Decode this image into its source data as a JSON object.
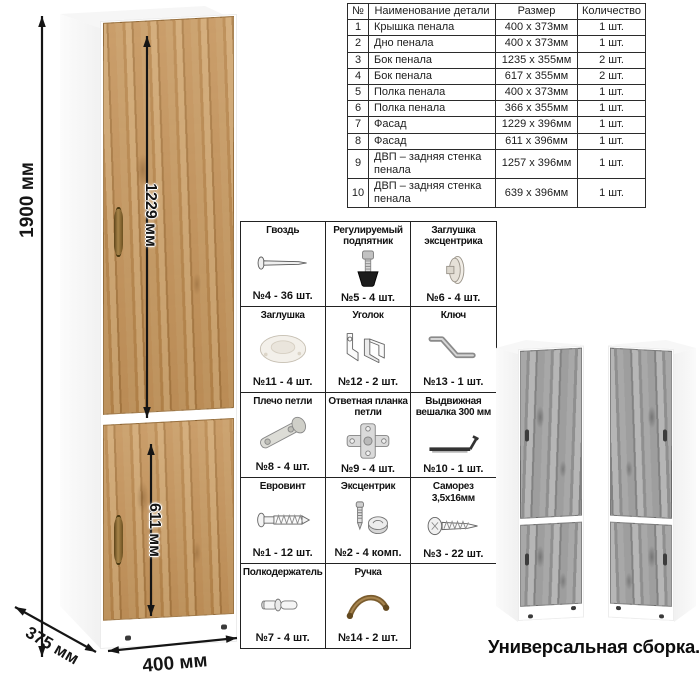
{
  "dims": {
    "height": "1900 мм",
    "upper_door": "1229 мм",
    "lower_door": "611 мм",
    "width": "400 мм",
    "depth": "375 мм"
  },
  "caption": "Универсальная сборка.",
  "parts_table": {
    "headers": [
      "№",
      "Наименование детали",
      "Размер",
      "Количество"
    ],
    "rows": [
      [
        "1",
        "Крышка пенала",
        "400 x 373мм",
        "1 шт."
      ],
      [
        "2",
        "Дно пенала",
        "400 x 373мм",
        "1 шт."
      ],
      [
        "3",
        "Бок пенала",
        "1235 x 355мм",
        "2 шт."
      ],
      [
        "4",
        "Бок пенала",
        "617 x 355мм",
        "2 шт."
      ],
      [
        "5",
        "Полка пенала",
        "400 x 373мм",
        "1 шт."
      ],
      [
        "6",
        "Полка пенала",
        "366 x 355мм",
        "1 шт."
      ],
      [
        "7",
        "Фасад",
        "1229 x 396мм",
        "1 шт."
      ],
      [
        "8",
        "Фасад",
        "611 x 396мм",
        "1 шт."
      ],
      [
        "9",
        "ДВП – задняя стенка пенала",
        "1257 x 396мм",
        "1 шт."
      ],
      [
        "10",
        "ДВП – задняя стенка пенала",
        "639 x 396мм",
        "1 шт."
      ]
    ]
  },
  "hardware": {
    "items": [
      {
        "name": "Гвоздь",
        "qty": "№4 - 36 шт.",
        "icon": "nail-icon"
      },
      {
        "name": "Регулируемый подпятник",
        "qty": "№5 - 4 шт.",
        "icon": "adjustable-foot-icon"
      },
      {
        "name": "Заглушка эксцентрика",
        "qty": "№6 - 4 шт.",
        "icon": "cam-cap-icon"
      },
      {
        "name": "Заглушка",
        "qty": "№11 - 4 шт.",
        "icon": "plug-cap-icon"
      },
      {
        "name": "Уголок",
        "qty": "№12 - 2 шт.",
        "icon": "corner-bracket-icon"
      },
      {
        "name": "Ключ",
        "qty": "№13 - 1 шт.",
        "icon": "hex-key-icon"
      },
      {
        "name": "Плечо петли",
        "qty": "№8 - 4 шт.",
        "icon": "hinge-arm-icon"
      },
      {
        "name": "Ответная планка петли",
        "qty": "№9 - 4 шт.",
        "icon": "hinge-plate-icon"
      },
      {
        "name": "Выдвижная вешалка 300 мм",
        "qty": "№10 - 1 шт.",
        "icon": "pullout-hanger-icon"
      },
      {
        "name": "Евровинт",
        "qty": "№1 - 12 шт.",
        "icon": "euro-screw-icon"
      },
      {
        "name": "Эксцентрик",
        "qty": "№2 - 4 комп.",
        "icon": "cam-lock-icon"
      },
      {
        "name": "Саморез 3,5х16мм",
        "qty": "№3 - 22 шт.",
        "icon": "self-tapping-screw-icon"
      },
      {
        "name": "Полкодержатель",
        "qty": "№7 - 4 шт.",
        "icon": "shelf-pin-icon"
      },
      {
        "name": "Ручка",
        "qty": "№14 - 2 шт.",
        "icon": "handle-icon"
      }
    ]
  },
  "colors": {
    "wood": "#c4935a",
    "wood_dark": "#aa7a42",
    "gray_wood": "#9e9e9e",
    "line": "#151515",
    "table_border": "#2b2b2b",
    "handle_bronze": "#8a6b3e"
  }
}
